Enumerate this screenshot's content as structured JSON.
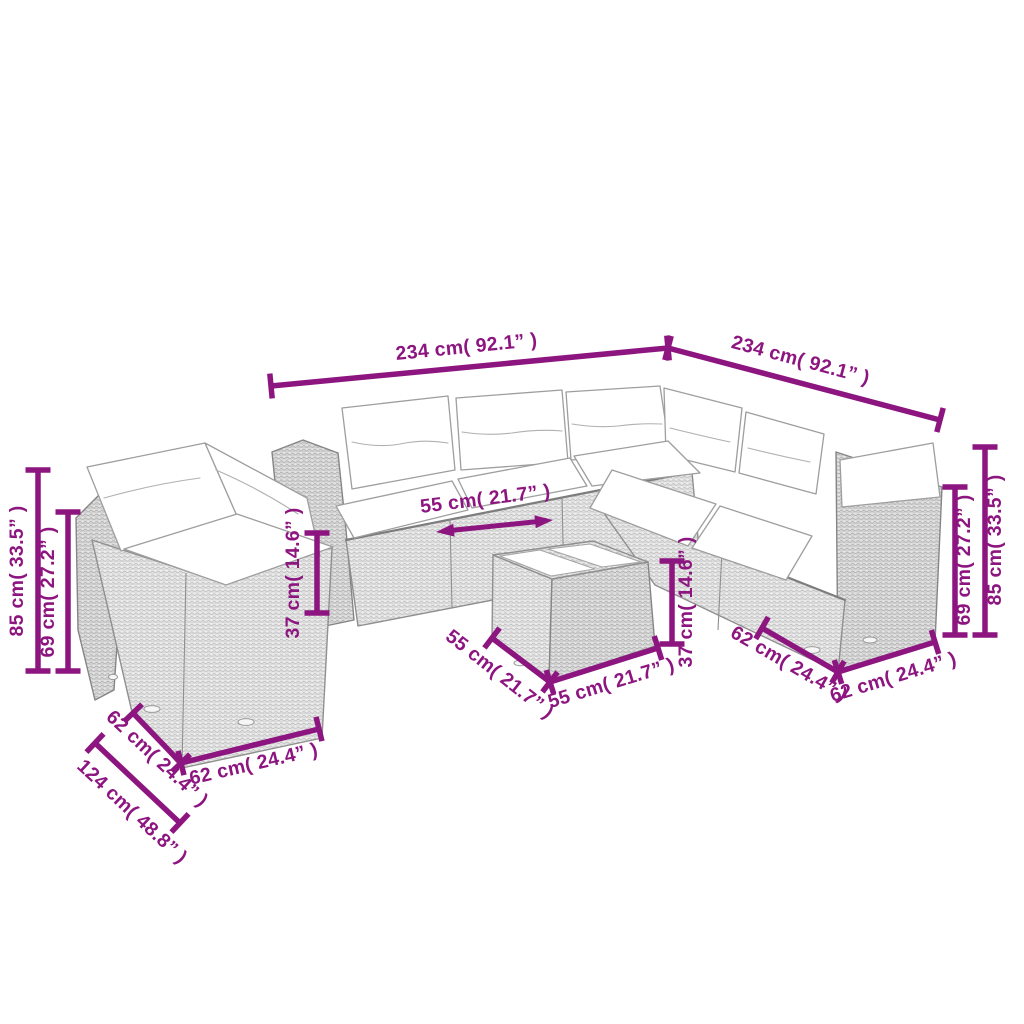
{
  "figure": {
    "description": "Line-art dimension diagram of a rattan garden lounge set with cushions and a glass-top coffee table",
    "background": "#ffffff"
  },
  "colors": {
    "dimension": "#8d1580",
    "outline": "#8f8f8f",
    "cushion": "#ffffff",
    "wicker_light": "#ededed",
    "wicker_weave": "#b9b9b9"
  },
  "dimensions": [
    {
      "id": "sofa-long-side-width",
      "label": "234 cm( 92.1” )",
      "line": [
        271,
        386,
        668,
        348
      ],
      "style": "tick",
      "label_pos": [
        467,
        353
      ],
      "label_rot": -5.7
    },
    {
      "id": "sofa-right-side-width",
      "label": "234 cm( 92.1” )",
      "line": [
        668,
        348,
        940,
        420
      ],
      "style": "tick",
      "label_pos": [
        799,
        366
      ],
      "label_rot": 15
    },
    {
      "id": "left-total-height",
      "label": "85 cm( 33.5” )",
      "line": [
        38,
        470,
        38,
        671
      ],
      "style": "tick",
      "label_pos": [
        23,
        571
      ],
      "label_rot": -90
    },
    {
      "id": "left-backrest-height",
      "label": "69 cm( 27.2” )",
      "line": [
        68,
        512,
        68,
        671
      ],
      "style": "tick",
      "label_pos": [
        54,
        592
      ],
      "label_rot": -90
    },
    {
      "id": "seat-height",
      "label": "37 cm( 14.6” )",
      "line": [
        317,
        533,
        317,
        613
      ],
      "style": "tick",
      "label_pos": [
        299,
        573
      ],
      "label_rot": -90
    },
    {
      "id": "seat-width",
      "label": "55 cm( 21.7” )",
      "line": [
        436,
        532,
        553,
        520
      ],
      "style": "arrow",
      "label_pos": [
        486,
        505
      ],
      "label_rot": -7
    },
    {
      "id": "left-seat-depth",
      "label": "62 cm( 24.4” )",
      "line": [
        133,
        713,
        181,
        763
      ],
      "style": "tick",
      "label_pos": [
        153,
        763
      ],
      "label_rot": 43
    },
    {
      "id": "corner-total-depth",
      "label": "124 cm( 48.8” )",
      "line": [
        95,
        743,
        180,
        823
      ],
      "style": "tick",
      "label_pos": [
        128,
        816
      ],
      "label_rot": 43
    },
    {
      "id": "left-seat-width",
      "label": "62 cm( 24.4” )",
      "line": [
        181,
        763,
        319,
        729
      ],
      "style": "tick",
      "label_pos": [
        255,
        770
      ],
      "label_rot": -13
    },
    {
      "id": "table-depth",
      "label": "55 cm( 21.7” )",
      "line": [
        492,
        638,
        550,
        682
      ],
      "style": "tick",
      "label_pos": [
        496,
        679
      ],
      "label_rot": 38
    },
    {
      "id": "table-width",
      "label": "55 cm( 21.7” )",
      "line": [
        550,
        682,
        658,
        648
      ],
      "style": "tick",
      "label_pos": [
        613,
        689
      ],
      "label_rot": -17
    },
    {
      "id": "table-height",
      "label": "37 cm( 14.6” )",
      "line": [
        672,
        561,
        672,
        644
      ],
      "style": "tick",
      "label_pos": [
        692,
        602
      ],
      "label_rot": -90
    },
    {
      "id": "right-seat-depth",
      "label": "62 cm( 24.4” )",
      "line": [
        762,
        628,
        838,
        672
      ],
      "style": "tick",
      "label_pos": [
        786,
        669
      ],
      "label_rot": 30
    },
    {
      "id": "right-seat-width",
      "label": "62 cm( 24.4” )",
      "line": [
        838,
        672,
        935,
        642
      ],
      "style": "tick",
      "label_pos": [
        895,
        683
      ],
      "label_rot": -17
    },
    {
      "id": "right-backrest-height",
      "label": "69 cm( 27.2” )",
      "line": [
        955,
        487,
        955,
        635
      ],
      "style": "tick",
      "label_pos": [
        970,
        560
      ],
      "label_rot": -90
    },
    {
      "id": "right-total-height",
      "label": "85 cm( 33.5” )",
      "line": [
        985,
        447,
        985,
        635
      ],
      "style": "tick",
      "label_pos": [
        1001,
        540
      ],
      "label_rot": -90
    }
  ]
}
